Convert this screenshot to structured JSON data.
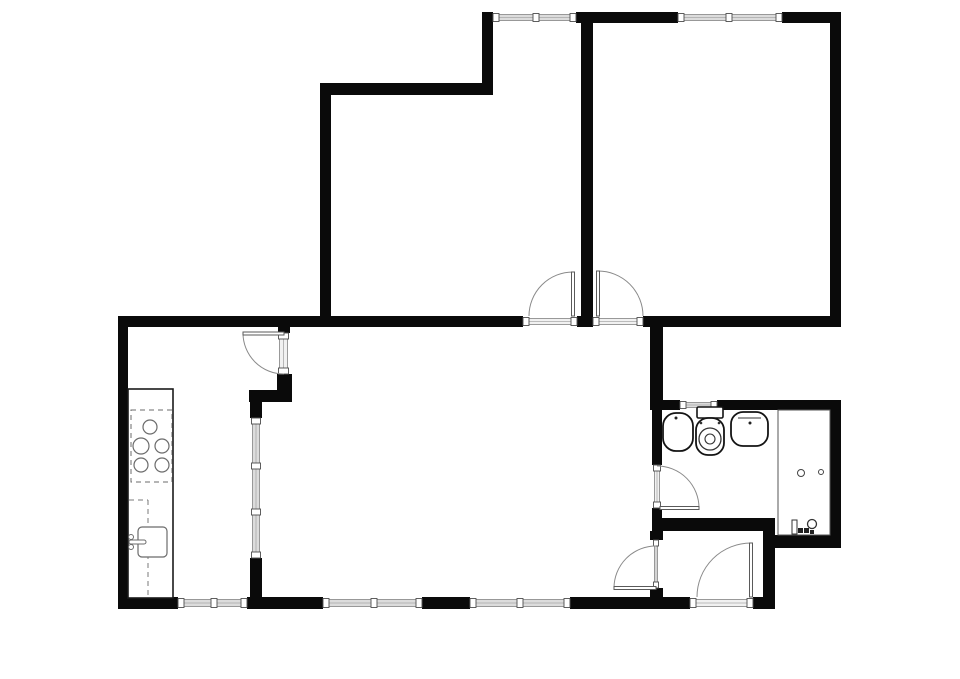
{
  "canvas": {
    "width": 960,
    "height": 679,
    "background": "#ffffff"
  },
  "style": {
    "wall_color": "#0a0a0a",
    "glass_fill": "#dcdcdc",
    "threshold_fill": "#f1f1f1",
    "glass_edge": "#8f8f8f",
    "glass_center": "#a8a8a8",
    "cap_stroke": "#4d4d4d",
    "arc_color": "#8a8a8a",
    "leaf_stroke": "#5a5a5a",
    "fixture_stroke": "#141414",
    "kitchen_stroke": "#6b6b6b",
    "dash_color": "#7a7a7a",
    "thin_stroke": "#555555",
    "counter_stroke": "#1a1a1a"
  },
  "floorplan": {
    "rooms": [
      {
        "name": "bedroom-top-middle",
        "x": 331,
        "y": 95,
        "w": 250,
        "h": 221
      },
      {
        "name": "bedroom-top-right",
        "x": 593,
        "y": 23,
        "w": 237,
        "h": 293
      },
      {
        "name": "kitchen",
        "x": 128,
        "y": 327,
        "w": 121,
        "h": 270
      },
      {
        "name": "living-room",
        "x": 290,
        "y": 327,
        "w": 360,
        "h": 270
      },
      {
        "name": "hallway",
        "x": 663,
        "y": 531,
        "w": 100,
        "h": 66
      },
      {
        "name": "bathroom",
        "x": 662,
        "y": 410,
        "w": 168,
        "h": 110
      }
    ],
    "walls": [
      {
        "name": "wall-top-middle",
        "x": 576,
        "y": 12,
        "w": 102,
        "h": 11
      },
      {
        "name": "wall-top-right",
        "x": 782,
        "y": 12,
        "w": 59,
        "h": 11
      },
      {
        "name": "wall-right-bedroom",
        "x": 830,
        "y": 12,
        "w": 11,
        "h": 315
      },
      {
        "name": "wall-top-connector",
        "x": 482,
        "y": 12,
        "w": 11,
        "h": 83
      },
      {
        "name": "wall-bedroom-middle-top",
        "x": 320,
        "y": 83,
        "w": 173,
        "h": 12
      },
      {
        "name": "wall-bedroom-middle-left",
        "x": 320,
        "y": 83,
        "w": 11,
        "h": 244
      },
      {
        "name": "wall-bedroom-divider",
        "x": 581,
        "y": 12,
        "w": 12,
        "h": 315
      },
      {
        "name": "wall-middle-left",
        "x": 118,
        "y": 316,
        "w": 405,
        "h": 11
      },
      {
        "name": "wall-middle-pillar",
        "x": 577,
        "y": 316,
        "w": 16,
        "h": 11
      },
      {
        "name": "wall-middle-right",
        "x": 643,
        "y": 316,
        "w": 198,
        "h": 11
      },
      {
        "name": "wall-left",
        "x": 118,
        "y": 316,
        "w": 10,
        "h": 293
      },
      {
        "name": "wall-bottom-1",
        "x": 118,
        "y": 597,
        "w": 60,
        "h": 12
      },
      {
        "name": "wall-bottom-2",
        "x": 247,
        "y": 597,
        "w": 76,
        "h": 12
      },
      {
        "name": "wall-bottom-3",
        "x": 422,
        "y": 597,
        "w": 48,
        "h": 12
      },
      {
        "name": "wall-bottom-4",
        "x": 570,
        "y": 597,
        "w": 120,
        "h": 12
      },
      {
        "name": "wall-bottom-5",
        "x": 753,
        "y": 597,
        "w": 22,
        "h": 12
      },
      {
        "name": "wall-kitchen-door-top",
        "x": 278,
        "y": 327,
        "w": 12,
        "h": 6
      },
      {
        "name": "wall-kitchen-door-bottom",
        "x": 277,
        "y": 374,
        "w": 15,
        "h": 16
      },
      {
        "name": "wall-kitchen-return",
        "x": 249,
        "y": 390,
        "w": 43,
        "h": 12
      },
      {
        "name": "wall-kitchen-glass-top",
        "x": 250,
        "y": 402,
        "w": 12,
        "h": 16
      },
      {
        "name": "wall-kitchen-glass-bottom",
        "x": 250,
        "y": 558,
        "w": 12,
        "h": 40
      },
      {
        "name": "wall-hall-upper",
        "x": 650,
        "y": 327,
        "w": 13,
        "h": 73
      },
      {
        "name": "wall-bath-top-left",
        "x": 650,
        "y": 400,
        "w": 30,
        "h": 10
      },
      {
        "name": "wall-bath-top-right",
        "x": 717,
        "y": 400,
        "w": 121,
        "h": 10
      },
      {
        "name": "wall-bath-left-upper",
        "x": 652,
        "y": 410,
        "w": 10,
        "h": 55
      },
      {
        "name": "wall-bath-left-lower",
        "x": 652,
        "y": 508,
        "w": 10,
        "h": 12
      },
      {
        "name": "wall-hall-bath-divider",
        "x": 652,
        "y": 518,
        "w": 123,
        "h": 13
      },
      {
        "name": "wall-hall-left-upper",
        "x": 650,
        "y": 531,
        "w": 13,
        "h": 9
      },
      {
        "name": "wall-hall-left-lower",
        "x": 650,
        "y": 588,
        "w": 13,
        "h": 10
      },
      {
        "name": "wall-hall-right",
        "x": 763,
        "y": 518,
        "w": 12,
        "h": 91
      },
      {
        "name": "wall-bath-bottom",
        "x": 775,
        "y": 535,
        "w": 66,
        "h": 13
      },
      {
        "name": "wall-bath-right",
        "x": 830,
        "y": 400,
        "w": 11,
        "h": 148
      }
    ],
    "windows": [
      {
        "name": "window-top-left",
        "o": "h",
        "x": 493,
        "y": 12,
        "w": 83,
        "h": 11,
        "mullions": [
          536
        ]
      },
      {
        "name": "window-top-right",
        "o": "h",
        "x": 678,
        "y": 12,
        "w": 104,
        "h": 11,
        "mullions": [
          729
        ]
      },
      {
        "name": "window-bottom-left",
        "o": "h",
        "x": 178,
        "y": 597,
        "w": 69,
        "h": 12,
        "mullions": [
          214
        ]
      },
      {
        "name": "window-bottom-middle",
        "o": "h",
        "x": 323,
        "y": 597,
        "w": 99,
        "h": 12,
        "mullions": [
          374
        ]
      },
      {
        "name": "window-bottom-right",
        "o": "h",
        "x": 470,
        "y": 597,
        "w": 100,
        "h": 12,
        "mullions": [
          520
        ]
      },
      {
        "name": "window-kitchen-partition",
        "o": "v",
        "x": 250,
        "y": 418,
        "w": 12,
        "h": 140,
        "mullions": [
          466,
          512
        ]
      },
      {
        "name": "window-bathroom",
        "o": "h",
        "x": 680,
        "y": 400,
        "w": 37,
        "h": 10,
        "mullions": []
      }
    ],
    "doors": [
      {
        "name": "door-bedroom-middle",
        "o": "h",
        "opening": {
          "x": 523,
          "y": 316,
          "w": 54,
          "h": 11
        },
        "leaf": {
          "x": 571.5,
          "y": 272,
          "w": 3,
          "h": 44
        },
        "arc": {
          "sx": 529,
          "sy": 316,
          "ex": 573,
          "ey": 272,
          "r": 44,
          "sweep": 1
        }
      },
      {
        "name": "door-bedroom-right",
        "o": "h",
        "opening": {
          "x": 593,
          "y": 316,
          "w": 50,
          "h": 11
        },
        "leaf": {
          "x": 596.5,
          "y": 271,
          "w": 3,
          "h": 45
        },
        "arc": {
          "sx": 598,
          "sy": 271,
          "ex": 643,
          "ey": 316,
          "r": 45,
          "sweep": 1
        }
      },
      {
        "name": "door-kitchen",
        "o": "v",
        "opening": {
          "x": 277,
          "y": 333,
          "w": 13,
          "h": 41
        },
        "leaf": {
          "x": 243,
          "y": 332,
          "w": 41,
          "h": 3
        },
        "arc": {
          "sx": 243,
          "sy": 333,
          "ex": 284,
          "ey": 374,
          "r": 41,
          "sweep": 0
        }
      },
      {
        "name": "door-bathroom",
        "o": "v",
        "opening": {
          "x": 652,
          "y": 465,
          "w": 10,
          "h": 43
        },
        "leaf": {
          "x": 660,
          "y": 506.5,
          "w": 39,
          "h": 3
        },
        "arc": {
          "sx": 657,
          "sy": 466,
          "ex": 699,
          "ey": 508,
          "r": 42,
          "sweep": 1
        }
      },
      {
        "name": "door-hallway",
        "o": "v",
        "opening": {
          "x": 652,
          "y": 540,
          "w": 8,
          "h": 48
        },
        "leaf": {
          "x": 614,
          "y": 586.5,
          "w": 42,
          "h": 3
        },
        "arc": {
          "sx": 614,
          "sy": 588,
          "ex": 656,
          "ey": 546,
          "r": 42,
          "sweep": 1
        }
      },
      {
        "name": "door-entrance",
        "o": "h",
        "opening": {
          "x": 690,
          "y": 597,
          "w": 63,
          "h": 12
        },
        "leaf": {
          "x": 749.5,
          "y": 543,
          "w": 3,
          "h": 54
        },
        "arc": {
          "sx": 697,
          "sy": 597,
          "ex": 751,
          "ey": 543,
          "r": 54,
          "sweep": 1
        }
      }
    ],
    "kitchen": {
      "counter": {
        "x": 128,
        "y": 389,
        "w": 45,
        "h": 209
      },
      "cooktop": {
        "x": 131,
        "y": 410,
        "w": 41,
        "h": 72
      },
      "burners": [
        {
          "cx": 150,
          "cy": 427,
          "r": 7
        },
        {
          "cx": 141,
          "cy": 446,
          "r": 8
        },
        {
          "cx": 162,
          "cy": 446,
          "r": 7
        },
        {
          "cx": 141,
          "cy": 465,
          "r": 7
        },
        {
          "cx": 162,
          "cy": 465,
          "r": 7
        }
      ],
      "dashes": [
        {
          "x1": 129,
          "y1": 500,
          "x2": 148,
          "y2": 500
        },
        {
          "x1": 148,
          "y1": 500,
          "x2": 148,
          "y2": 595
        }
      ],
      "sink": {
        "x": 138,
        "y": 527,
        "w": 29,
        "h": 30,
        "rx": 4
      },
      "faucet": {
        "knobs": [
          {
            "cx": 131,
            "cy": 537,
            "r": 2.5
          },
          {
            "cx": 131,
            "cy": 547,
            "r": 2.5
          }
        ],
        "spout": {
          "x": 129,
          "y": 540,
          "w": 17,
          "h": 4
        }
      }
    },
    "bathroom": {
      "basin_left": {
        "x": 663,
        "y": 413,
        "w": 30,
        "h": 38,
        "rx": 13,
        "dot": {
          "cx": 676,
          "cy": 418,
          "r": 1.5
        }
      },
      "toilet": {
        "tank": {
          "x": 697,
          "y": 407,
          "w": 26,
          "h": 11
        },
        "bowl": {
          "x": 696,
          "y": 418,
          "w": 28,
          "h": 37,
          "rx": 12
        },
        "seat": {
          "cx": 710,
          "cy": 439,
          "r": 11
        },
        "hole": {
          "cx": 710,
          "cy": 439,
          "r": 5
        },
        "hinges": [
          {
            "cx": 701,
            "cy": 423,
            "r": 1.3
          },
          {
            "cx": 719,
            "cy": 423,
            "r": 1.3
          }
        ]
      },
      "basin_right": {
        "x": 731,
        "y": 412,
        "w": 37,
        "h": 34,
        "rx": 12,
        "line": {
          "x1": 738,
          "y1": 418,
          "x2": 761,
          "y2": 418
        },
        "dot": {
          "cx": 750,
          "cy": 423,
          "r": 1.5
        }
      },
      "shower": {
        "x": 778,
        "y": 410,
        "w": 52,
        "h": 125,
        "knobs": [
          {
            "cx": 801,
            "cy": 473,
            "r": 3.5
          },
          {
            "cx": 821,
            "cy": 472,
            "r": 2.5
          }
        ]
      },
      "accessories": [
        {
          "type": "rect",
          "x": 792,
          "y": 520,
          "w": 5,
          "h": 14
        },
        {
          "type": "square",
          "x": 798,
          "y": 528,
          "w": 5,
          "h": 5
        },
        {
          "type": "square",
          "x": 804,
          "y": 528,
          "w": 5,
          "h": 5
        },
        {
          "type": "circle",
          "cx": 812,
          "cy": 524,
          "r": 4.5
        },
        {
          "type": "square",
          "x": 810,
          "y": 530,
          "w": 4,
          "h": 4
        }
      ]
    }
  }
}
